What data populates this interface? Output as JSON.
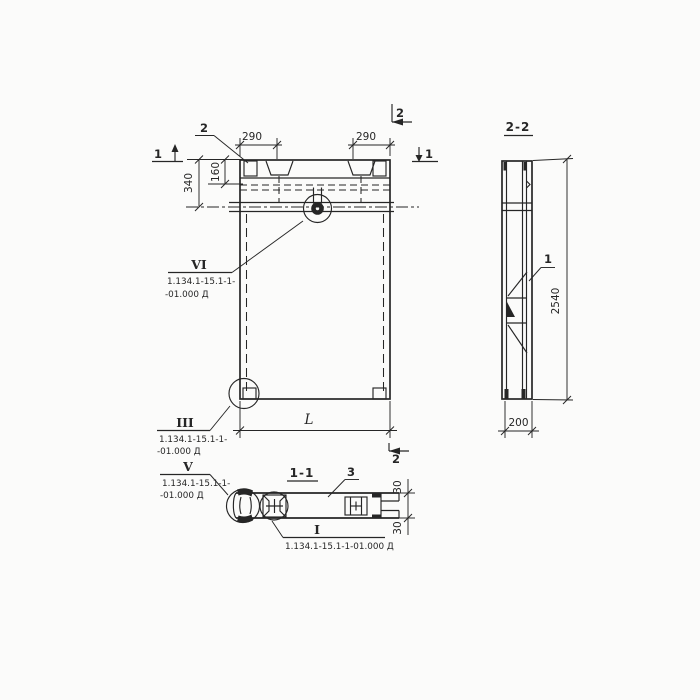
{
  "colors": {
    "paper": "#fbfbfa",
    "ink": "#262626"
  },
  "front": {
    "dim_290_left": "290",
    "dim_290_right": "290",
    "dim_160": "160",
    "dim_340": "340",
    "dim_L": "L",
    "sec1_left": "1",
    "sec1_right": "1",
    "sec2_top": "2",
    "sec2_bottom": "2",
    "anchor_ref": "2"
  },
  "callout_vi": {
    "num": "VI",
    "doc1": "1.134.1-15.1-1-",
    "doc2": "-01.000 Д"
  },
  "callout_iii": {
    "num": "III",
    "doc1": "1.134.1-15.1-1-",
    "doc2": "-01.000 Д"
  },
  "callout_v": {
    "num": "V",
    "doc1": "1.134.1-15.1-1-",
    "doc2": "-01.000 Д"
  },
  "callout_i": {
    "num": "I",
    "doc": "1.134.1-15.1-1-01.000 Д"
  },
  "plan": {
    "title": "1-1",
    "ref_3": "3",
    "dim_30_top": "30",
    "dim_30_bottom": "30"
  },
  "side": {
    "title": "2-2",
    "ref_1": "1",
    "dim_2540": "2540",
    "dim_200": "200"
  }
}
